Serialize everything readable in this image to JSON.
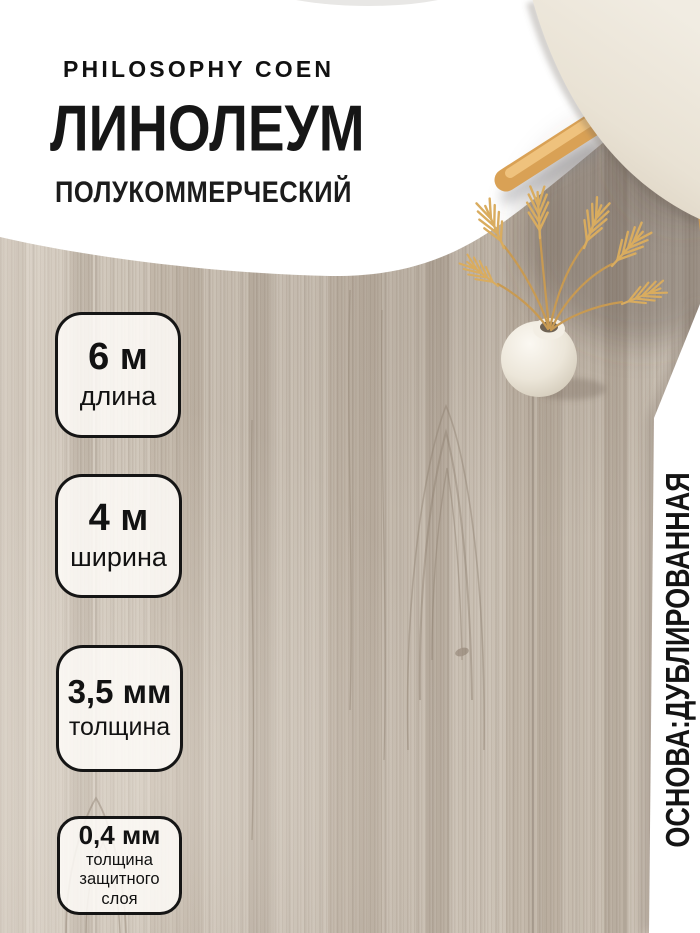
{
  "product": {
    "brand": "PHILOSOPHY COEN",
    "title": "ЛИНОЛЕУМ",
    "subtitle": "ПОЛУКОММЕРЧЕСКИЙ",
    "side_note": "ОСНОВА:ДУБЛИРОВАННАЯ"
  },
  "badges": [
    {
      "value": "6 м",
      "label": "длина"
    },
    {
      "value": "4 м",
      "label": "ширина"
    },
    {
      "value": "3,5 мм",
      "label": "толщина"
    },
    {
      "value": "0,4 мм",
      "label": "толщина защитного слоя"
    }
  ],
  "colors": {
    "text": "#161616",
    "badge_border": "#151515",
    "badge_background": "#fffdf9",
    "overlay_white": "#ffffff",
    "floor_base": "#c9bfb2",
    "floor_grain": "#8f8171",
    "chair_wood": "#d9a155",
    "chair_cushion": "#e9e2d4",
    "wheat_gold": "#d9ac5f",
    "vase": "#ece6d9"
  }
}
